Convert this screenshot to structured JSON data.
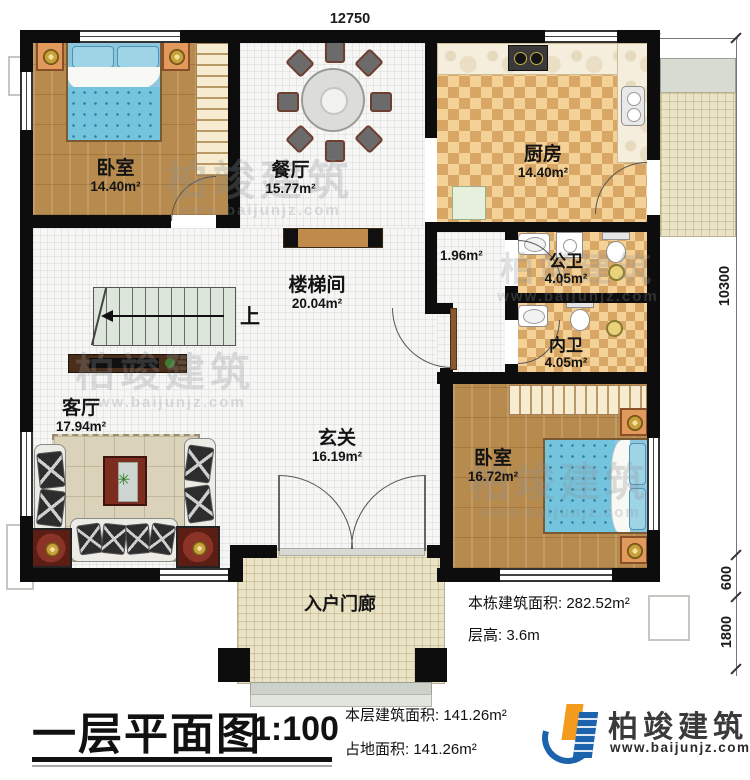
{
  "dims": {
    "top": "12750",
    "right_main": "10300",
    "right_step": "600",
    "right_porch": "1800"
  },
  "rooms": {
    "bedroom1": {
      "name": "卧室",
      "area": "14.40m²"
    },
    "dining": {
      "name": "餐厅",
      "area": "15.77m²"
    },
    "kitchen": {
      "name": "厨房",
      "area": "14.40m²"
    },
    "bath_public": {
      "name": "公卫",
      "area": "4.05m²"
    },
    "bath_inner": {
      "name": "内卫",
      "area": "4.05m²"
    },
    "stairwell": {
      "name": "楼梯间",
      "area": "20.04m²"
    },
    "living": {
      "name": "客厅",
      "area": "17.94m²"
    },
    "foyer": {
      "name": "玄关",
      "area": "16.19m²"
    },
    "bedroom2": {
      "name": "卧室",
      "area": "16.72m²"
    },
    "porch": {
      "name": "入户门廊"
    },
    "corridor": {
      "area": "1.96m²"
    },
    "stair_up": "上"
  },
  "titleblock": {
    "title": "一层平面图",
    "scale": "1:100",
    "floor_area_label": "本层建筑面积: ",
    "floor_area_value": "141.26m²",
    "site_area_label": "占地面积: ",
    "site_area_value": "141.26m²"
  },
  "notes": {
    "total_area_label": "本栋建筑面积: ",
    "total_area_value": "282.52m²",
    "height_label": "层高: ",
    "height_value": "3.6m"
  },
  "brand": {
    "name": "柏竣建筑",
    "site": "www.baijunjz.com"
  },
  "watermark": {
    "name": "柏竣建筑",
    "site": "www.baijunjz.com"
  },
  "colors": {
    "wall": "#0d0d0d",
    "wood_floor": "#b78a4d",
    "checker_light": "#f4d197",
    "checker_dark": "#d8a766",
    "porch_tile": "#ebe3c6",
    "bed_blue": "#74c4dd",
    "brand_blue": "#1b63ad",
    "brand_orange": "#f29b1d"
  }
}
